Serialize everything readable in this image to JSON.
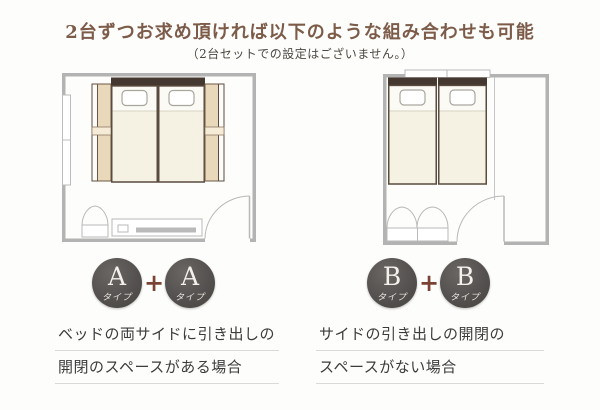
{
  "header": {
    "title": "2台ずつお求め頂ければ以下のような組み合わせも可能",
    "subtitle": "（2台セットでの設定はございません。）"
  },
  "options": [
    {
      "id": "A-plus-A",
      "badges": [
        {
          "letter": "A",
          "sub": "タイプ"
        },
        {
          "letter": "A",
          "sub": "タイプ"
        }
      ],
      "plus": "+",
      "caption": [
        "ベッドの両サイドに引き出しの",
        "開閉のスペースがある場合"
      ]
    },
    {
      "id": "B-plus-B",
      "badges": [
        {
          "letter": "B",
          "sub": "タイプ"
        },
        {
          "letter": "B",
          "sub": "タイプ"
        }
      ],
      "plus": "+",
      "caption": [
        "サイドの引き出しの開閉の",
        "スペースがない場合"
      ]
    }
  ],
  "colors": {
    "title_brown": "#7d5b49",
    "plus_red_brown": "#7c4335",
    "badge_gray": "#555150",
    "badge_text": "#f4f1ec",
    "wall_gray": "#b3b3b3",
    "headboard_brown": "#453830",
    "mattress_ivory": "#f5f2e4",
    "drawer_beige": "#e9d8ba",
    "caption_text": "#3c3c3c"
  }
}
